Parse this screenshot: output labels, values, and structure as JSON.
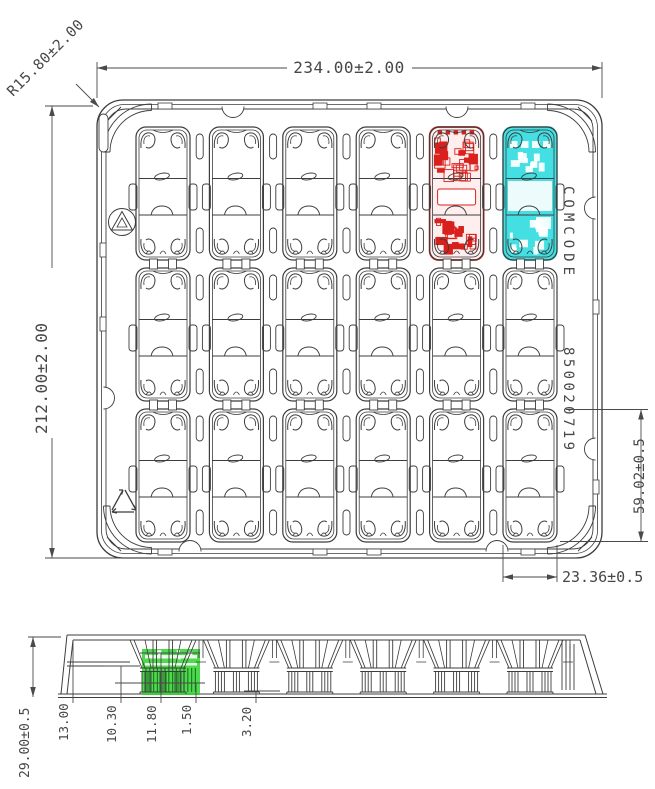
{
  "drawing": {
    "title": "Plastic shipping tray drawing",
    "top_view": {
      "overall_width": "234.00±2.00",
      "overall_height": "212.00±2.00",
      "corner_radius": "R15.80±2.00",
      "pocket_height": "59.02±0.5",
      "pocket_width": "23.36±0.5",
      "comcode_label": "COMCODE",
      "comcode_number": "850020719",
      "grid": {
        "rows": 3,
        "columns": 6
      }
    },
    "side_view": {
      "overall_height": "29.00±0.5",
      "step_heights": [
        "13.00",
        "10.30",
        "11.80",
        "1.50",
        "3.20"
      ]
    },
    "highlights": {
      "red_device_color": "#da201d",
      "cyan_device_color": "#35dde0",
      "green_device_color": "#2fd32f"
    },
    "line_color": "#3d3d3d"
  }
}
